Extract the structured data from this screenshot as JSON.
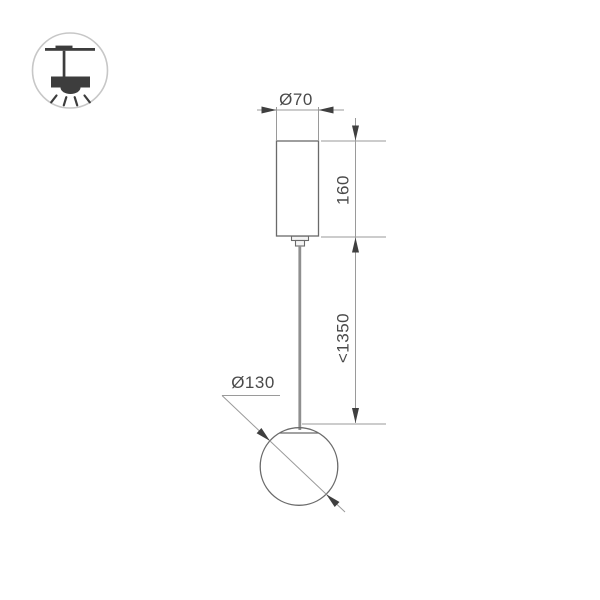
{
  "page": {
    "background_color": "#ffffff",
    "type": "product-technical-drawing"
  },
  "legend_icon": {
    "name": "pendant-ceiling-light-icon",
    "description": "ceiling mounted pendant lamp glyph in circle"
  },
  "drawing": {
    "fixture": {
      "parts": [
        "canopy-cylinder",
        "ceiling-connector",
        "suspension-cable",
        "glass-sphere"
      ]
    },
    "dimensions": {
      "canopy_diameter": "Ø70",
      "canopy_height": "160",
      "suspension_length": "<1350",
      "sphere_diameter": "Ø130"
    },
    "colors": {
      "object_line": "#6a6a6a",
      "dimension_line": "#9a9a9a",
      "arrow_fill": "#3f3f3f",
      "text": "#4a4a4a",
      "cable": "#8f8f8f",
      "icon_fill": "#3d3d3d",
      "icon_circle_border": "#c7c7c7"
    }
  }
}
